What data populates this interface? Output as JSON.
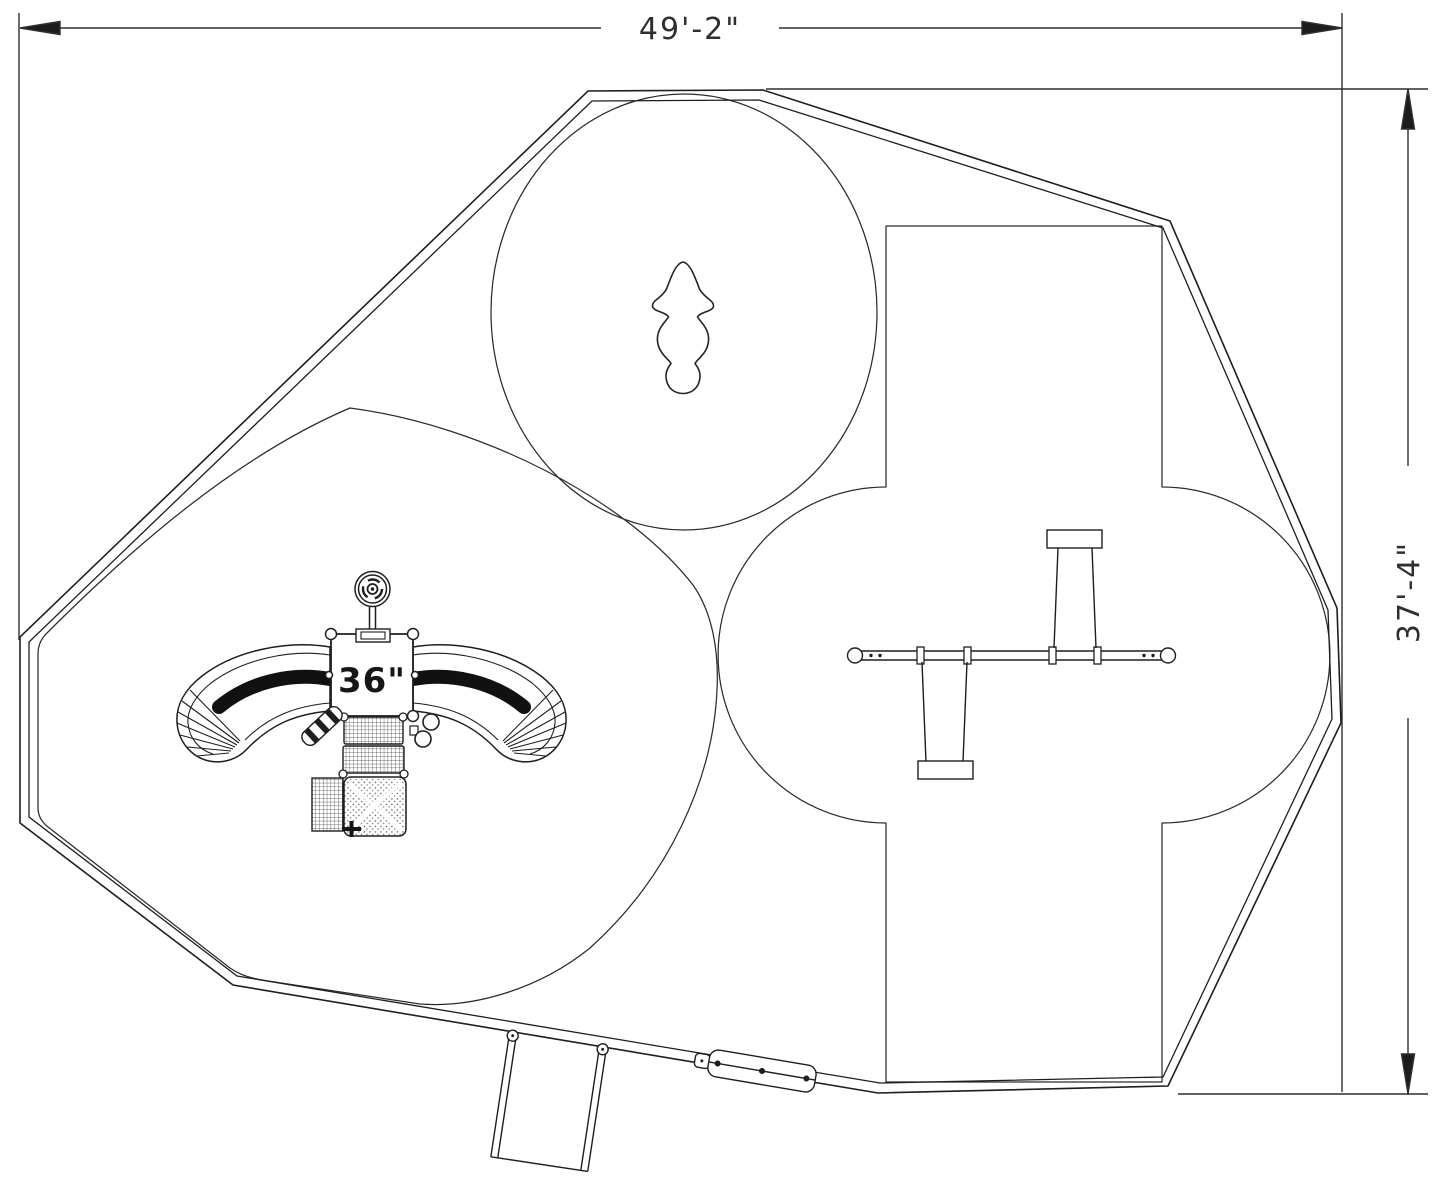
{
  "drawing": {
    "background_color": "#ffffff",
    "line_color": "#1e1e1e",
    "dimension_color": "#2f2f2f",
    "dimension_width_label": "49'-2\"",
    "dimension_height_label": "37'-4\"",
    "deck_height_label": "36\""
  }
}
